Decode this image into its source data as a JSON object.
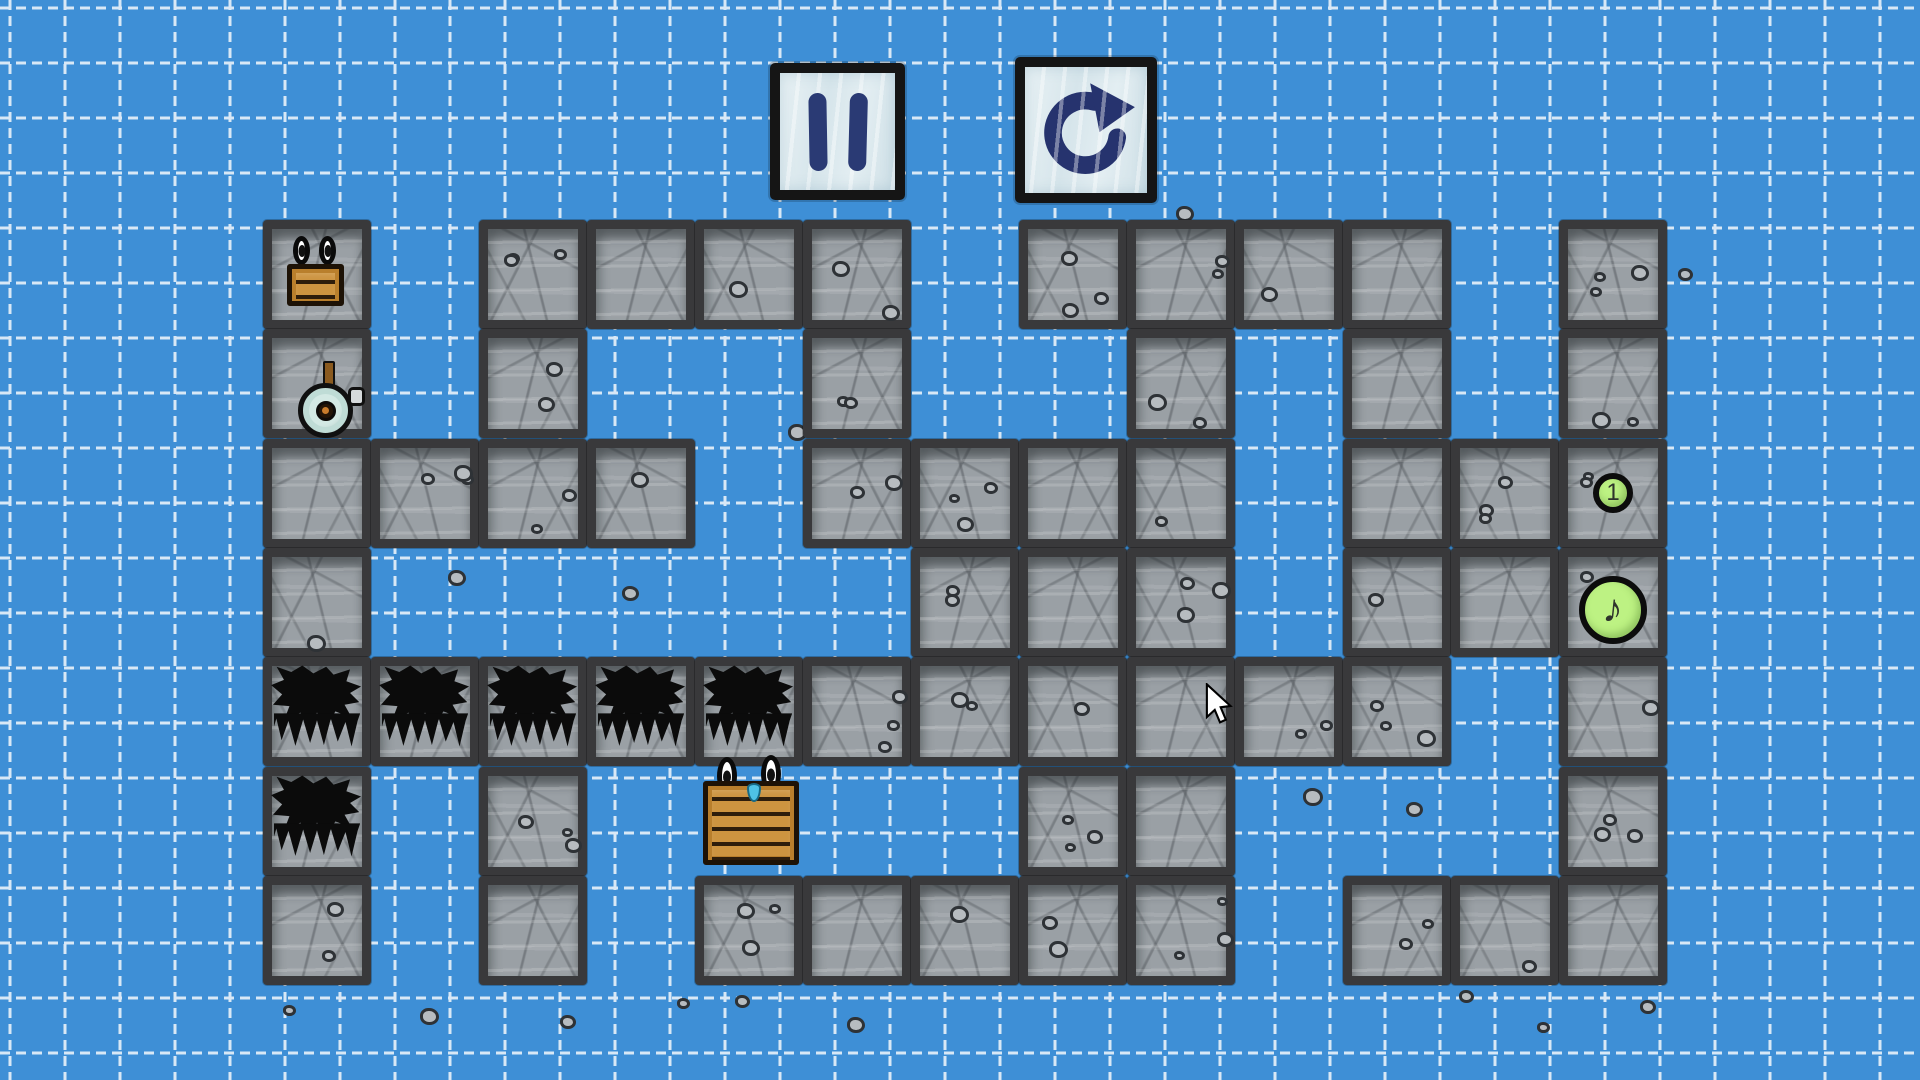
{
  "hud": {
    "pause_button": {
      "icon": "pause-icon"
    },
    "restart_button": {
      "icon": "restart-arrow-icon"
    }
  },
  "level": {
    "grid": {
      "cols": 13,
      "rows": 7,
      "legend": {
        "S": "stone-block",
        "K": "spike-block",
        ".": "empty"
      },
      "map": [
        "S.SSSS.SSSS.S",
        "S.S..S..S.S.S",
        "SSSS.SSSS.SSS",
        "S.....SSS.SSS",
        "KKKKKSSSSSS.S",
        "K.S....SS...S",
        "S.S.SSSSS.SSS"
      ]
    },
    "entities": [
      {
        "name": "small-crate",
        "cell": [
          0,
          0
        ],
        "eyes": "0 0"
      },
      {
        "name": "bomb-character",
        "cell": [
          0,
          1
        ]
      },
      {
        "name": "big-crate",
        "cell": [
          4,
          5
        ],
        "eyes": "0 0",
        "sweat_drop": true
      },
      {
        "name": "switch-button-1",
        "cell": [
          12,
          2
        ],
        "label": "1"
      },
      {
        "name": "music-note-button",
        "cell": [
          12,
          3
        ],
        "glyph": "♪"
      }
    ],
    "loose_pebbles": [
      [
        283,
        1005
      ],
      [
        420,
        1008
      ],
      [
        560,
        1015
      ],
      [
        677,
        998
      ],
      [
        847,
        1017
      ],
      [
        1459,
        990
      ],
      [
        1537,
        1022
      ],
      [
        1640,
        1000
      ],
      [
        1678,
        268
      ],
      [
        448,
        570
      ],
      [
        622,
        586
      ],
      [
        788,
        424
      ],
      [
        1303,
        788
      ],
      [
        1406,
        802
      ],
      [
        1176,
        206
      ],
      [
        735,
        995
      ]
    ]
  },
  "cursor": {
    "x": 1205,
    "y": 683
  },
  "colors": {
    "background": "#3e8fd6",
    "grid_line": "#ffffff",
    "stone": "#9aa0a5",
    "stone_border": "#39393b",
    "spike": "#0b0b0b",
    "crate": "#cd9440",
    "button_green": "#bdf283",
    "glyph_navy": "#2a3a74"
  }
}
